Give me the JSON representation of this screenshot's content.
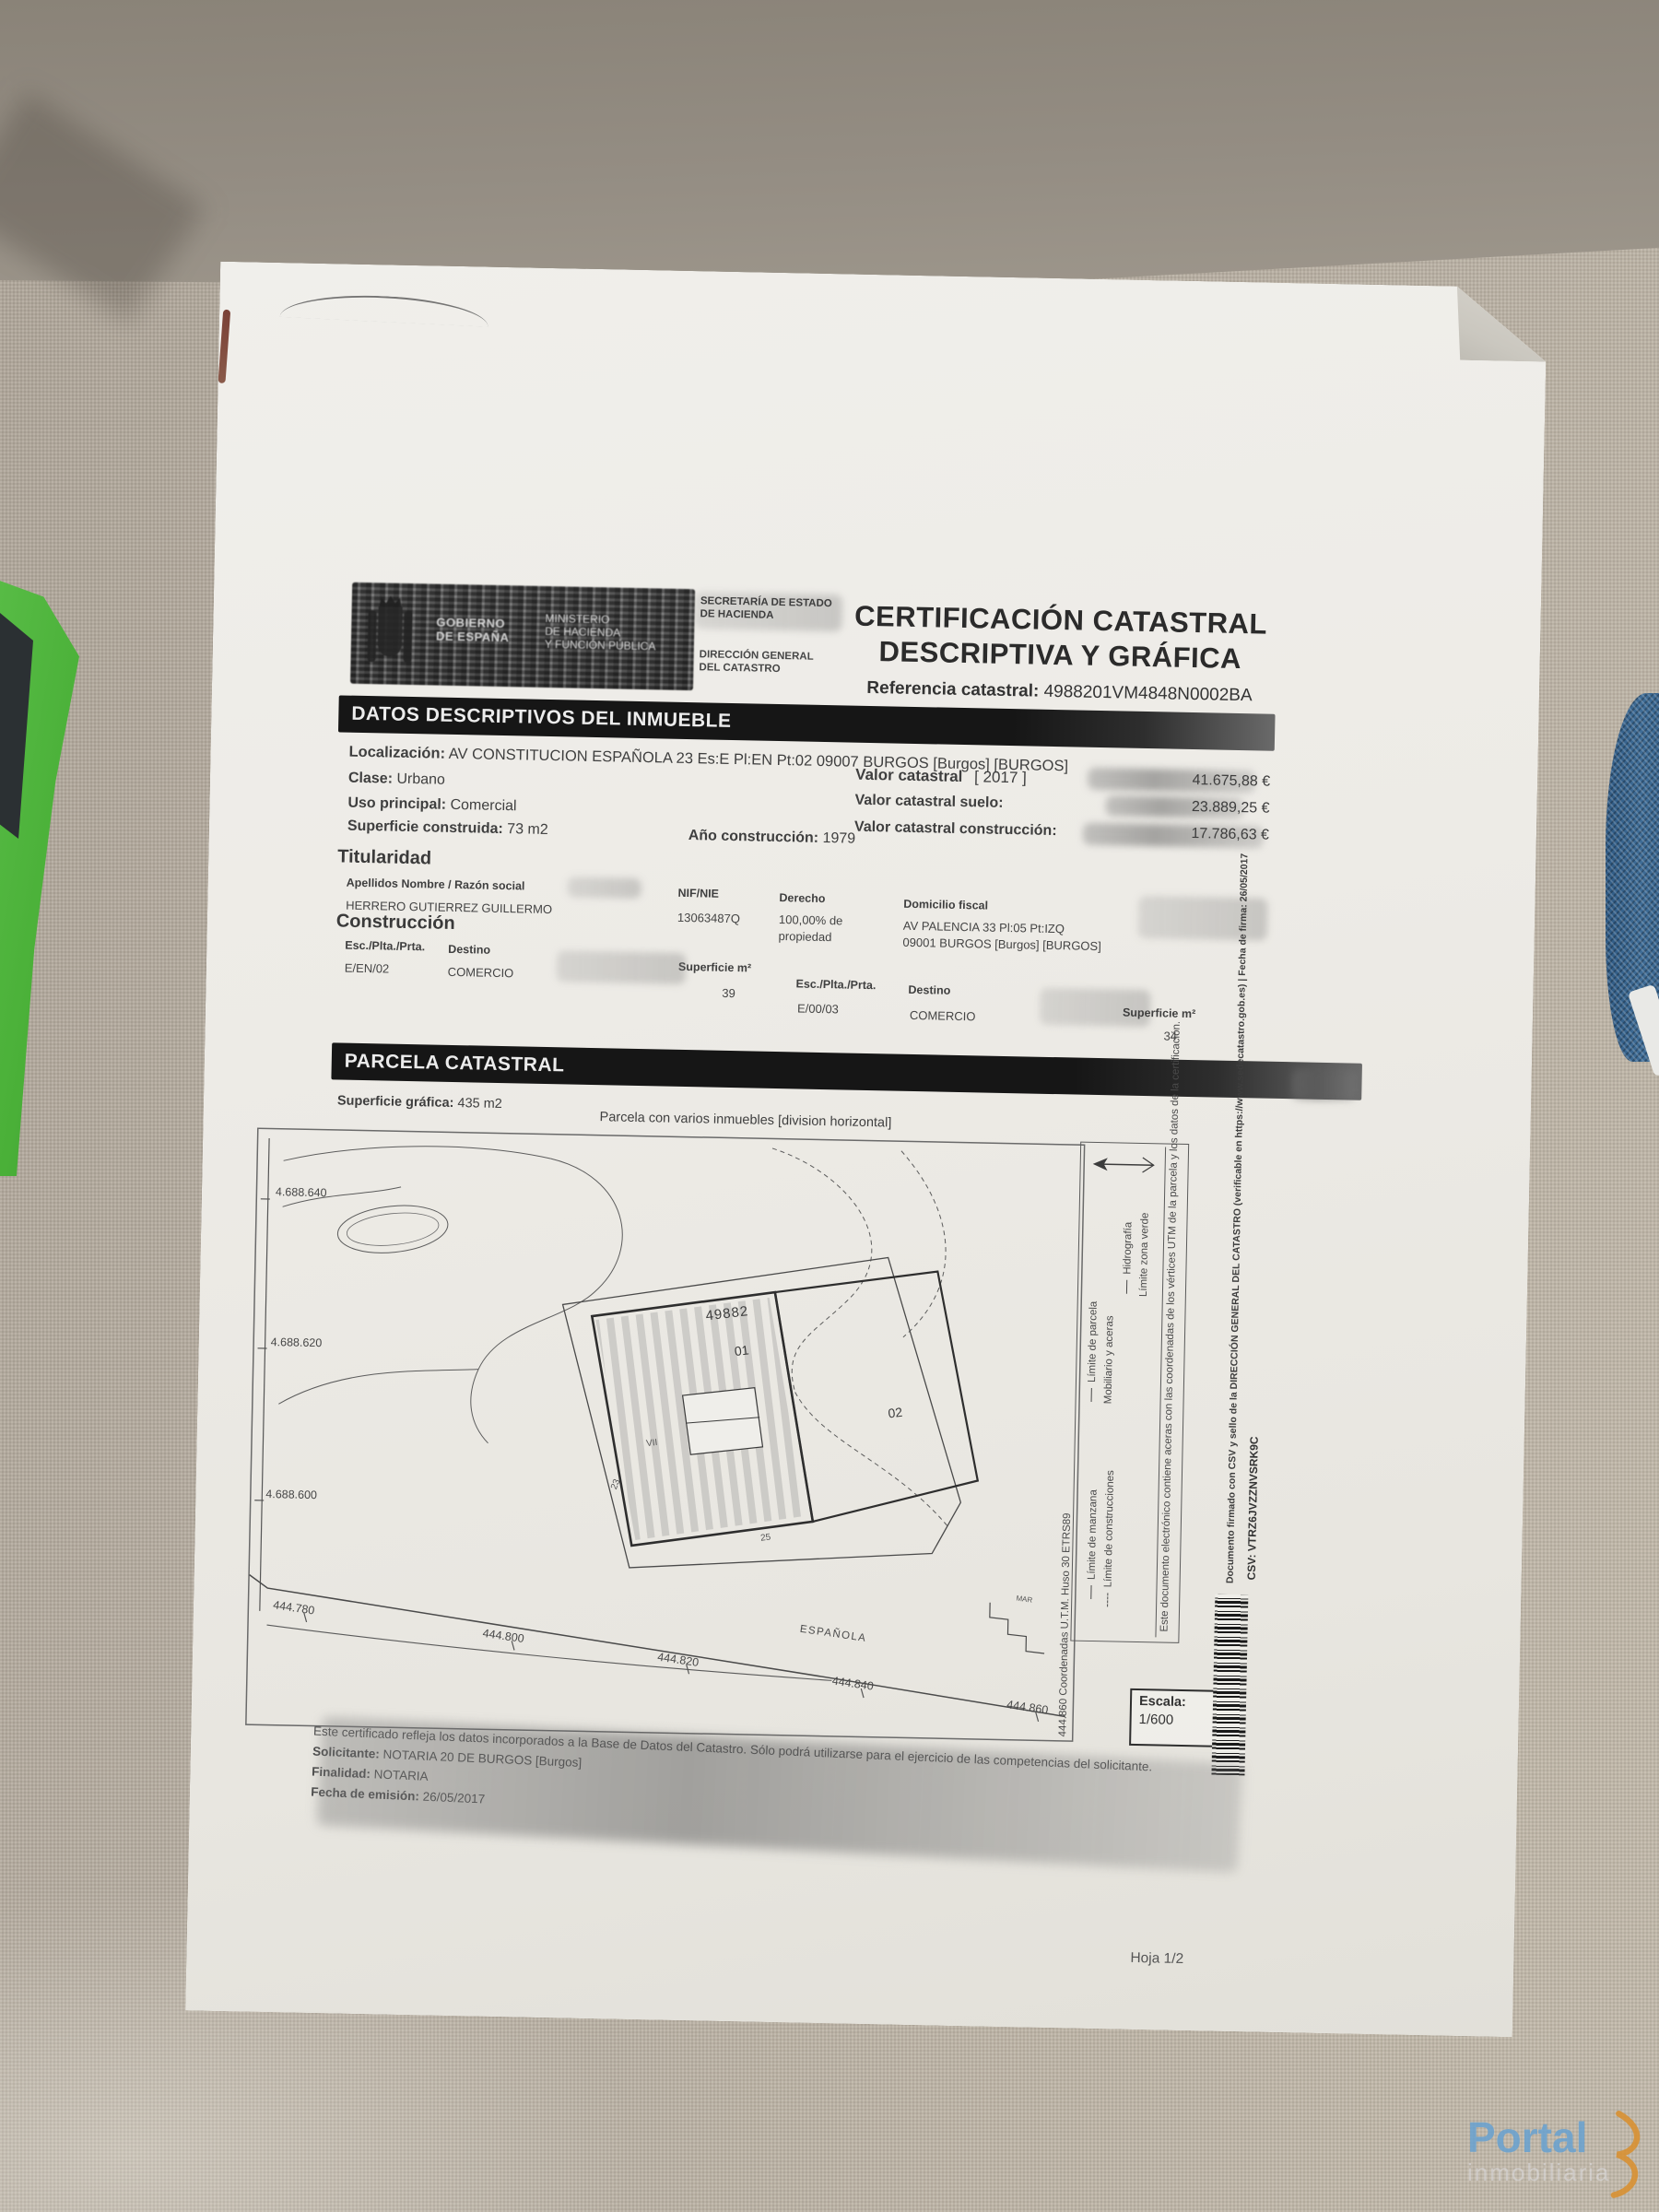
{
  "photo": {
    "watermark": {
      "brand": "Portal",
      "sub": "inmobiliaria"
    }
  },
  "doc": {
    "agency": {
      "gob1": "GOBIERNO",
      "gob2": "DE ESPAÑA",
      "min1": "MINISTERIO",
      "min2": "DE HACIENDA",
      "min3": "Y FUNCIÓN PÚBLICA",
      "sec1": "SECRETARÍA DE ESTADO",
      "sec2": "DE HACIENDA",
      "dir1": "DIRECCIÓN GENERAL",
      "dir2": "DEL CATASTRO"
    },
    "title": {
      "line1": "CERTIFICACIÓN CATASTRAL",
      "line2": "DESCRIPTIVA Y GRÁFICA",
      "ref_label": "Referencia catastral:",
      "ref_value": "4988201VM4848N0002BA"
    },
    "datos": {
      "bar": "DATOS DESCRIPTIVOS DEL INMUEBLE",
      "localizacion_label": "Localización:",
      "localizacion": "AV CONSTITUCION ESPAÑOLA 23 Es:E Pl:EN Pt:02 09007 BURGOS [Burgos] [BURGOS]",
      "clase_label": "Clase:",
      "clase": "Urbano",
      "uso_label": "Uso principal:",
      "uso": "Comercial",
      "sup_label": "Superficie construida:",
      "sup": "73 m2",
      "anio_label": "Año construcción:",
      "anio": "1979",
      "vc_label": "Valor catastral",
      "vc_year": "[ 2017 ]",
      "vc": "41.675,88 €",
      "vs_label": "Valor catastral suelo:",
      "vs": "23.889,25 €",
      "vcon_label": "Valor catastral construcción:",
      "vcon": "17.786,63 €"
    },
    "titularidad": {
      "heading": "Titularidad",
      "h_nombre": "Apellidos Nombre / Razón social",
      "h_nif": "NIF/NIE",
      "h_derecho": "Derecho",
      "h_domicilio": "Domicilio fiscal",
      "nombre": "HERRERO GUTIERREZ GUILLERMO",
      "nif": "13063487Q",
      "derecho_pct": "100,00% de",
      "derecho_tipo": "propiedad",
      "dom1": "AV PALENCIA 33 Pl:05 Pt:IZQ",
      "dom2": "09001 BURGOS [Burgos] [BURGOS]"
    },
    "construccion": {
      "heading": "Construcción",
      "h_esc": "Esc./Plta./Prta.",
      "h_destino": "Destino",
      "h_sup": "Superficie m²",
      "rows": [
        {
          "esc": "E/EN/02",
          "destino": "COMERCIO",
          "sup": "39"
        },
        {
          "esc": "E/00/03",
          "destino": "COMERCIO",
          "sup": "34"
        }
      ]
    },
    "parcela": {
      "bar": "PARCELA CATASTRAL",
      "sg_label": "Superficie gráfica:",
      "sg": "435 m2",
      "nota": "Parcela con varios inmuebles [division horizontal]"
    },
    "map": {
      "y_ticks": [
        "4.688.640",
        "4.688.620",
        "4.688.600"
      ],
      "x_ticks": [
        "444.780",
        "444.800",
        "444.820",
        "444.840",
        "444.860"
      ],
      "parcel_number": "49882",
      "unit1": "01",
      "unit2": "02",
      "n23": "23",
      "n25": "25",
      "vii": "VII",
      "street": "ESPAÑOLA",
      "mar": "MAR",
      "escala_label": "Escala:",
      "escala": "1/600",
      "legend": {
        "manzana": "Límite de manzana",
        "construcciones": "Límite de construcciones",
        "parcela": "Límite de parcela",
        "mobiliario": "Mobiliario y aceras",
        "hidrografia": "Hidrografía",
        "zona_verde": "Límite zona verde"
      },
      "coords_note": "444.860 Coordenadas U.T.M. Huso 30 ETRS89",
      "nota_electronica": "Este documento electrónico contiene aceras con las coordenadas de los vértices UTM de la parcela y los datos de la certificación."
    },
    "footer": {
      "line1": "Este certificado refleja los datos incorporados a la Base de Datos del Catastro. Sólo podrá utilizarse para el ejercicio de las competencias del solicitante.",
      "sol_label": "Solicitante:",
      "sol": "NOTARIA 20 DE BURGOS [Burgos]",
      "fin_label": "Finalidad:",
      "fin": "NOTARIA",
      "fecha_label": "Fecha de emisión:",
      "fecha": "26/05/2017",
      "hoja": "Hoja 1/2"
    },
    "side": {
      "firma": "Documento firmado con CSV y sello de la DIRECCIÓN GENERAL DEL CATASTRO (verificable en https://www.sedecatastro.gob.es) | Fecha de firma: 26/05/2017",
      "csv_label": "CSV:",
      "csv": "VTRZ6JVZZNVSRK9C"
    }
  }
}
